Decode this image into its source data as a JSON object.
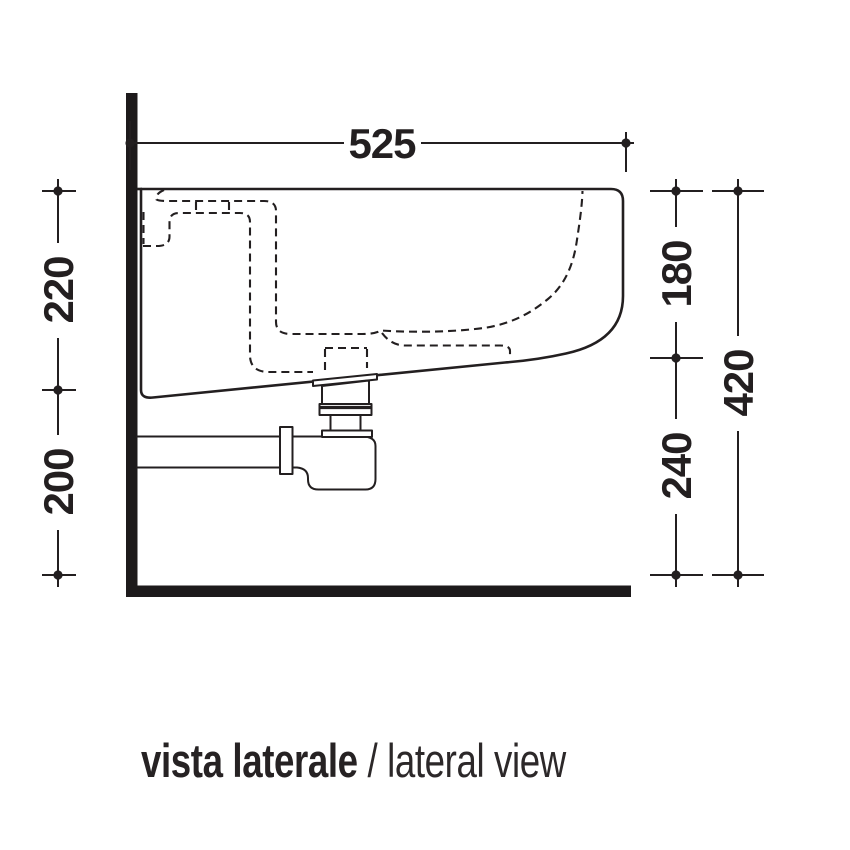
{
  "drawing": {
    "dimensions": {
      "top_width": "525",
      "left_upper": "220",
      "left_lower": "200",
      "right_upper": "180",
      "right_lower": "240",
      "right_total": "420"
    },
    "caption": {
      "italian": "vista laterale",
      "separator": " / ",
      "english": "lateral view"
    },
    "colors": {
      "line": "#231f20",
      "wall": "#1d1a1b",
      "background": "#ffffff"
    }
  }
}
